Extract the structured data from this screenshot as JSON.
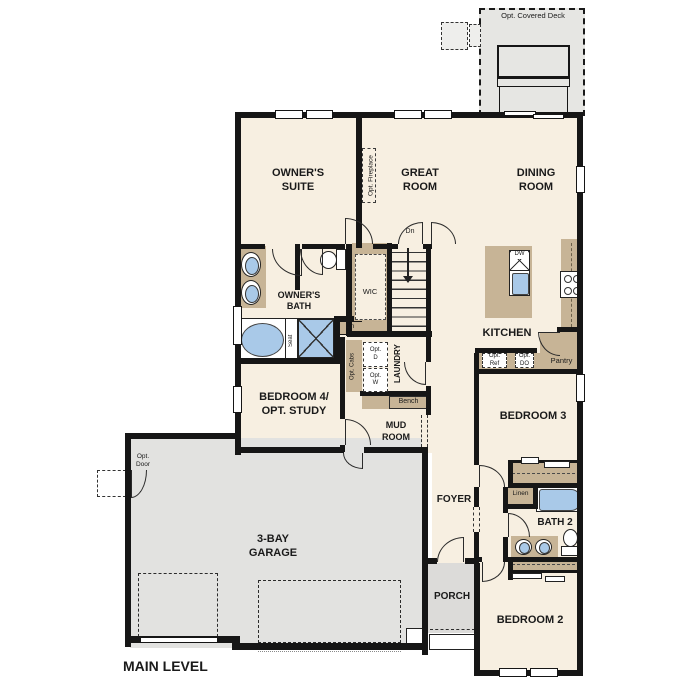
{
  "plan_title": "MAIN LEVEL",
  "deck": {
    "label": "Opt. Covered Deck"
  },
  "rooms": {
    "owners_suite": "OWNER'S\nSUITE",
    "great_room": "GREAT\nROOM",
    "dining_room": "DINING\nROOM",
    "kitchen": "KITCHEN",
    "owners_bath": "OWNER'S\nBATH",
    "wic": "WIC",
    "laundry": "LAUNDRY",
    "bedroom4": "BEDROOM 4/\nOPT. STUDY",
    "mud_room": "MUD\nROOM",
    "foyer": "FOYER",
    "bedroom3": "BEDROOM 3",
    "bath2": "BATH 2",
    "bedroom2": "BEDROOM 2",
    "porch": "PORCH",
    "garage": "3-BAY\nGARAGE"
  },
  "annotations": {
    "opt_fireplace": "Opt. Fireplace",
    "dn": "Dn",
    "dw": "DW",
    "opt_ref": "Opt.\nRef",
    "opt_do": "Opt.\nDO",
    "pantry": "Pantry",
    "lin": "Lin",
    "linen": "Linen",
    "seat": "Seat",
    "opt_cabs": "Opt. Cabs",
    "opt_d": "Opt.\nD",
    "opt_w": "Opt.\nW",
    "bench": "Bench",
    "opt_door": "Opt.\nDoor"
  },
  "colors": {
    "floor": "#f7efe1",
    "wall": "#161616",
    "cabinet_tan": "#c7b496",
    "fixture_blue": "#a9c9e8",
    "garage_gray": "#e2e2e0",
    "porch_gray": "#dcdbd9",
    "deck_gray": "#e6e6e3"
  }
}
